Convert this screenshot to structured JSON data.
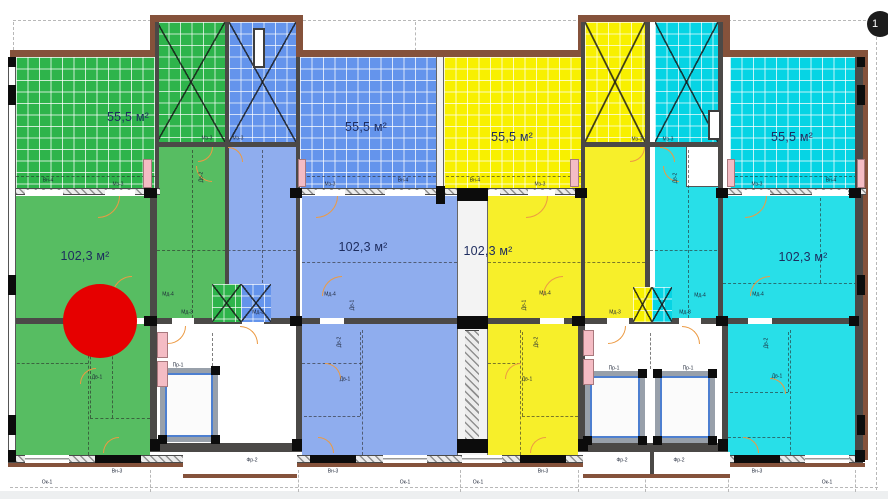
{
  "plan": {
    "floor_badge": "1",
    "units": [
      {
        "id": "green",
        "terrace_area": "55,5 м²",
        "apartment_area": "102,3 м²"
      },
      {
        "id": "blue",
        "terrace_area": "55,5 м²",
        "apartment_area": "102,3 м²"
      },
      {
        "id": "yellow",
        "terrace_area": "55,5 м²",
        "apartment_area": "102,3 м²"
      },
      {
        "id": "cyan",
        "terrace_area": "55,5 м²",
        "apartment_area": "102,3 м²"
      }
    ],
    "colors": {
      "green_grid": "#2eb44b",
      "green_flat": "#57bd62",
      "blue_grid": "#6494ec",
      "blue_flat": "#8fadee",
      "yellow_grid": "#f8f000",
      "yellow_flat": "#f7ef2a",
      "cyan_grid": "#06d4e4",
      "cyan_flat": "#28dfe8",
      "marker_red": "#e60000"
    },
    "marker": {
      "shape": "circle",
      "color": "#e60000"
    },
    "annotations": [
      {
        "t": "Вн-4",
        "x": 48,
        "y": 181
      },
      {
        "t": "Вн-4",
        "x": 403,
        "y": 181
      },
      {
        "t": "Вн-4",
        "x": 475,
        "y": 181
      },
      {
        "t": "Вн-4",
        "x": 831,
        "y": 181
      },
      {
        "t": "Мз-3",
        "x": 118,
        "y": 185
      },
      {
        "t": "Мз-3",
        "x": 330,
        "y": 185
      },
      {
        "t": "Мз-3",
        "x": 540,
        "y": 185
      },
      {
        "t": "Мз-3",
        "x": 757,
        "y": 185
      },
      {
        "t": "Мз-3",
        "x": 207,
        "y": 139
      },
      {
        "t": "Мз-3",
        "x": 238,
        "y": 139
      },
      {
        "t": "Мз-3",
        "x": 637,
        "y": 140
      },
      {
        "t": "Мз-3",
        "x": 668,
        "y": 140
      },
      {
        "t": "Мд-4",
        "x": 168,
        "y": 295
      },
      {
        "t": "Мд-4",
        "x": 330,
        "y": 295
      },
      {
        "t": "Мд-4",
        "x": 545,
        "y": 294
      },
      {
        "t": "Мд-4",
        "x": 700,
        "y": 296
      },
      {
        "t": "Мд-4",
        "x": 758,
        "y": 295
      },
      {
        "t": "Мд-3",
        "x": 187,
        "y": 313
      },
      {
        "t": "Мд-3",
        "x": 258,
        "y": 313
      },
      {
        "t": "Мд-3",
        "x": 615,
        "y": 313
      },
      {
        "t": "Мд-3",
        "x": 685,
        "y": 313
      },
      {
        "t": "Дв-1",
        "x": 97,
        "y": 378
      },
      {
        "t": "Дв-1",
        "x": 345,
        "y": 380
      },
      {
        "t": "Дв-1",
        "x": 527,
        "y": 380
      },
      {
        "t": "Дв-1",
        "x": 777,
        "y": 377
      },
      {
        "t": "Дв-1",
        "x": 353,
        "y": 305,
        "r": -90
      },
      {
        "t": "Дв-1",
        "x": 525,
        "y": 305,
        "r": -90
      },
      {
        "t": "Дв-2",
        "x": 202,
        "y": 177,
        "r": -90
      },
      {
        "t": "Дв-2",
        "x": 676,
        "y": 178,
        "r": -90
      },
      {
        "t": "Дв-2",
        "x": 340,
        "y": 342,
        "r": -90
      },
      {
        "t": "Дв-2",
        "x": 537,
        "y": 342,
        "r": -90
      },
      {
        "t": "Дв-2",
        "x": 767,
        "y": 343,
        "r": -90
      },
      {
        "t": "Пр-1",
        "x": 178,
        "y": 366
      },
      {
        "t": "Пр-1",
        "x": 614,
        "y": 369
      },
      {
        "t": "Пр-1",
        "x": 688,
        "y": 369
      },
      {
        "t": "Фр-2",
        "x": 252,
        "y": 461
      },
      {
        "t": "Фр-2",
        "x": 622,
        "y": 461
      },
      {
        "t": "Фр-2",
        "x": 679,
        "y": 461
      },
      {
        "t": "Ок-1",
        "x": 47,
        "y": 483
      },
      {
        "t": "Ок-1",
        "x": 405,
        "y": 483
      },
      {
        "t": "Ок-1",
        "x": 478,
        "y": 483
      },
      {
        "t": "Ок-1",
        "x": 827,
        "y": 483
      },
      {
        "t": "Вн-3",
        "x": 117,
        "y": 472
      },
      {
        "t": "Вн-3",
        "x": 333,
        "y": 472
      },
      {
        "t": "Вн-3",
        "x": 543,
        "y": 472
      },
      {
        "t": "Вн-3",
        "x": 757,
        "y": 472
      }
    ]
  }
}
